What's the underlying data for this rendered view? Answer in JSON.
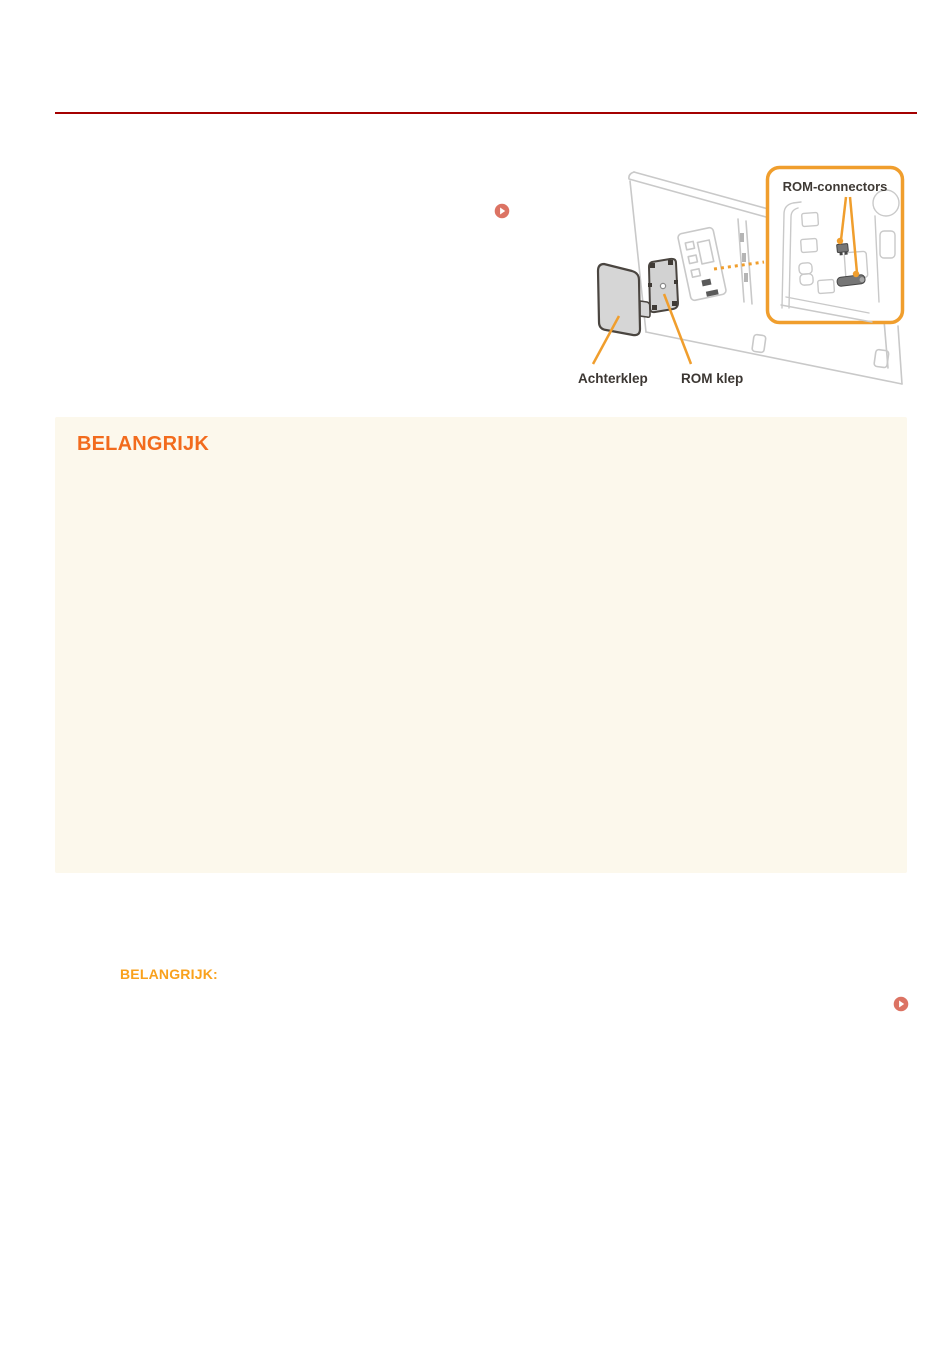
{
  "page": {
    "background": "#ffffff",
    "divider_color": "#a40000"
  },
  "icons": {
    "link_marker": "play-icon",
    "link_marker_color": "#dc7363"
  },
  "figure": {
    "callout": {
      "label": "ROM-connectors"
    },
    "part_labels": {
      "back_cover": "Achterklep",
      "rom_cover": "ROM klep"
    },
    "colors": {
      "accent_orange": "#f09e2d",
      "outline_gray": "#c9c9c9",
      "cover_stroke": "#4a4540",
      "cover_fill": "#d6d6d6",
      "label_text": "#3c3733"
    }
  },
  "important_box": {
    "title": "BELANGRIJK",
    "background": "#fcf8ec",
    "title_color": "#f26b1d"
  },
  "important_note": {
    "title": "BELANGRIJK:",
    "title_color": "#f9a11c"
  }
}
